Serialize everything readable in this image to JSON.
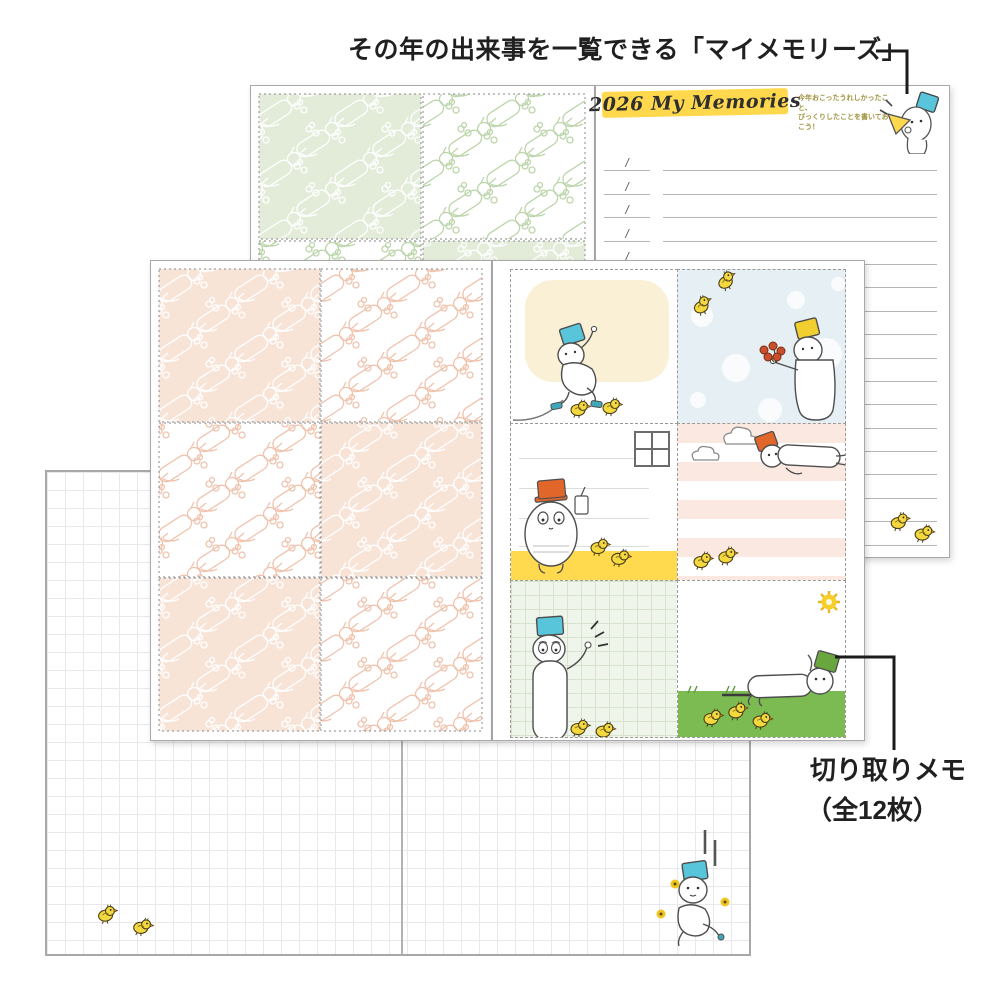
{
  "annotations": {
    "top_label": "その年の出来事を一覧できる「マイメモリーズ」",
    "cutoff_memo_label_line1": "切り取りメモ",
    "cutoff_memo_label_line2": "（全12枚）"
  },
  "memories_page": {
    "title": "2026 My Memories",
    "subtitle_line1": "今年おこったうれしかったこと、",
    "subtitle_line2": "びっくりしたことを書いておこう！",
    "date_separator": "/",
    "entry_rows": 17
  },
  "icons": {
    "chick-icon": "small yellow chick doodle",
    "sun-icon": "yellow scribble sun",
    "window-icon": "four-pane window outline",
    "cloud-icon": "outlined cloud",
    "bucket-hat-icon": "bucket worn as hat",
    "megaphone-icon": "yellow megaphone",
    "flower-bouquet-icon": "red flower bunch"
  },
  "colors": {
    "highlight-yellow": "#ffd84e",
    "accent-yellow-band": "#ffd94e",
    "sky-blue": "#e6eff4",
    "cream": "#faf0d5",
    "stripe-pink": "#fbe9e1",
    "grid-green": "#f0f5ec",
    "grass-green": "#7cba52",
    "pattern-pink": "#f8e3d7",
    "pattern-pink-line": "#efc3ae",
    "pattern-green": "#e2ecd9",
    "pattern-green-line": "#bcd5ab",
    "bucket-cyan": "#58c5da",
    "bucket-orange": "#e0662a",
    "bucket-yellow": "#f0cf2e",
    "bucket-green": "#69a63e",
    "chick-yellow": "#f4d83f",
    "flower-red": "#c94f2d",
    "annotation-ink": "#1b1b1b"
  }
}
